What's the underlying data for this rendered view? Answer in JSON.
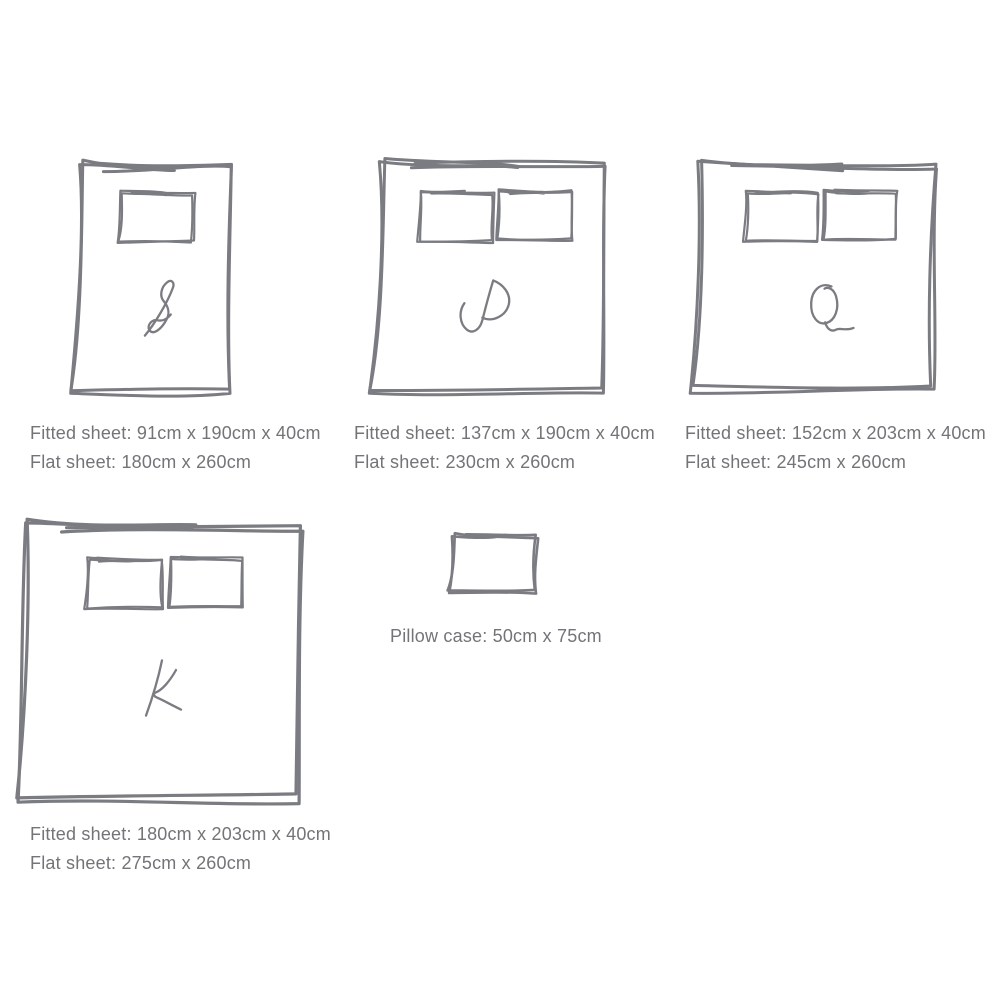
{
  "colors": {
    "ink": "#7b7c82",
    "text": "#737478",
    "background": "#ffffff"
  },
  "sizes": [
    {
      "key": "single",
      "letter": "S",
      "pillows": 1,
      "fitted_label": "Fitted sheet: 91cm x 190cm x 40cm",
      "flat_label": "Flat sheet: 180cm x 260cm"
    },
    {
      "key": "double",
      "letter": "D",
      "pillows": 2,
      "fitted_label": "Fitted sheet: 137cm x 190cm x 40cm",
      "flat_label": "Flat sheet: 230cm x 260cm"
    },
    {
      "key": "queen",
      "letter": "Q",
      "pillows": 2,
      "fitted_label": "Fitted sheet: 152cm x 203cm x 40cm",
      "flat_label": "Flat sheet: 245cm x 260cm"
    },
    {
      "key": "king",
      "letter": "K",
      "pillows": 2,
      "fitted_label": "Fitted sheet: 180cm x 203cm x 40cm",
      "flat_label": "Flat sheet: 275cm x 260cm"
    }
  ],
  "pillow_case": {
    "label": "Pillow case: 50cm x 75cm"
  }
}
